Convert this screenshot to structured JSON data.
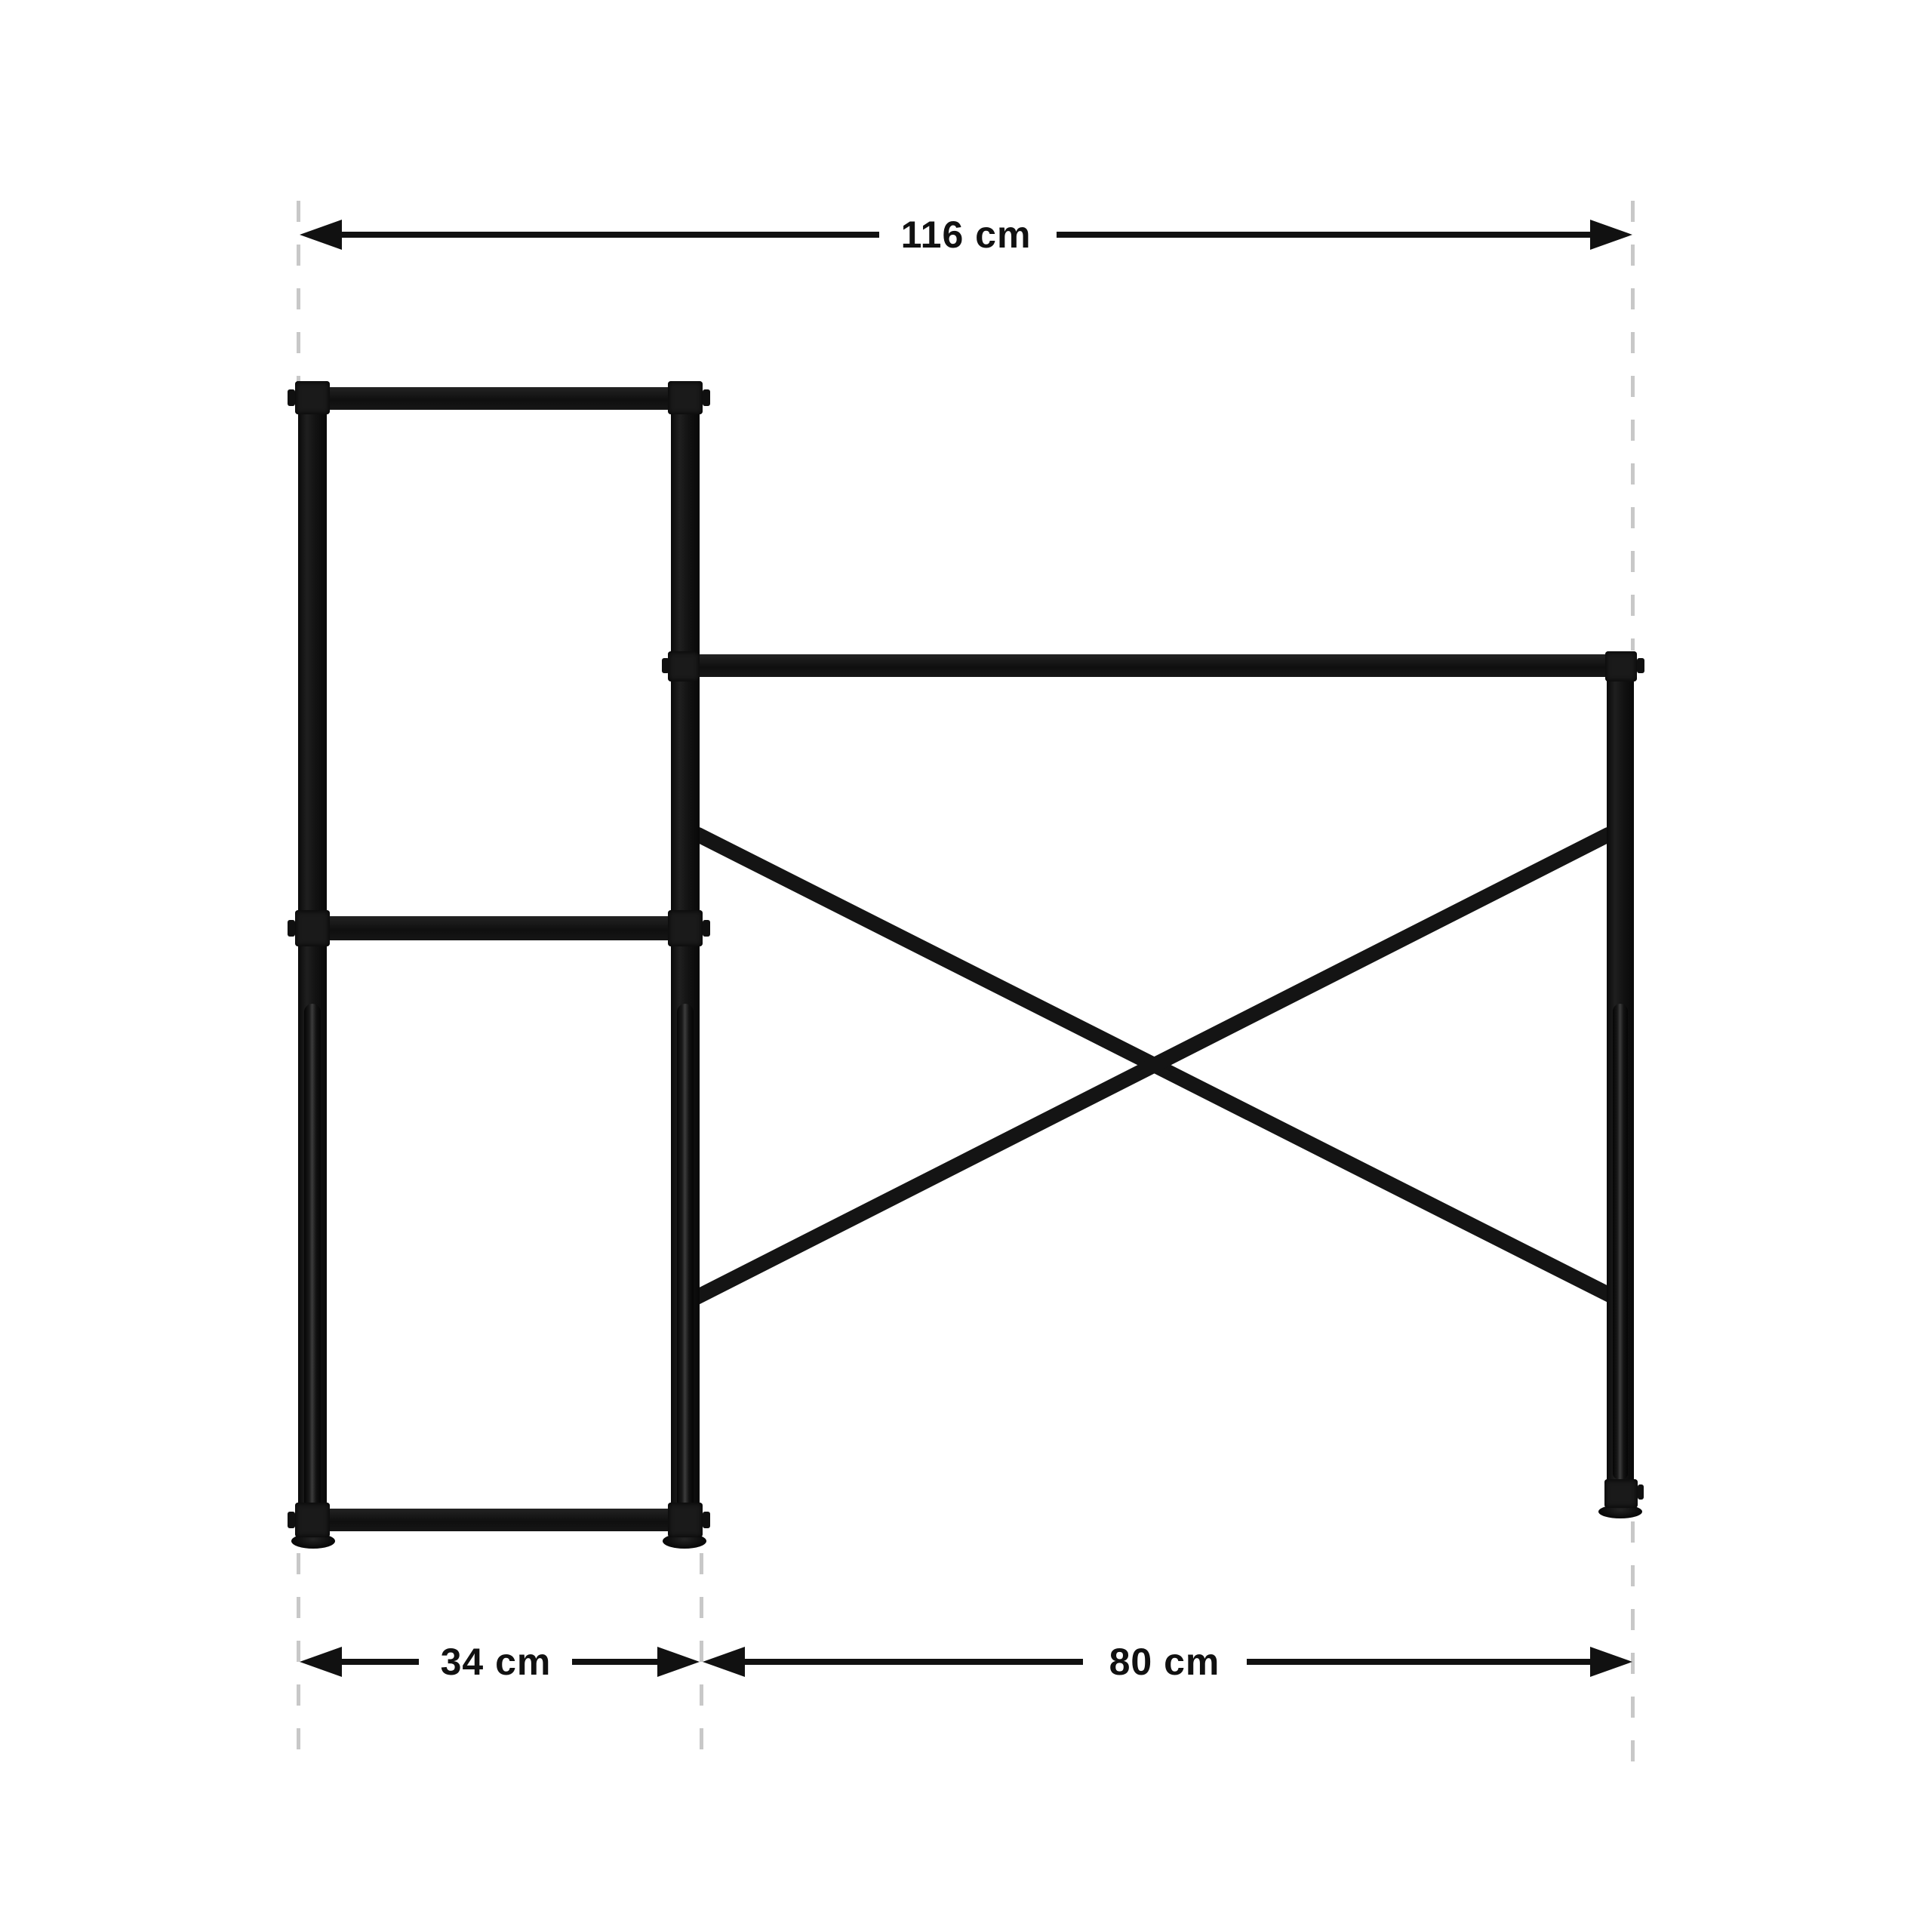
{
  "diagram": {
    "type": "furniture-dimension-diagram",
    "product": "desk-with-side-shelf-frame",
    "dimension_labels": {
      "overall_width": "116 cm",
      "shelf_depth": "34 cm",
      "desk_width": "80 cm"
    },
    "colors": {
      "background": "#ffffff",
      "frame": "#141414",
      "dimension_ink": "#111111",
      "guide_dash": "#c8c8c8"
    }
  }
}
